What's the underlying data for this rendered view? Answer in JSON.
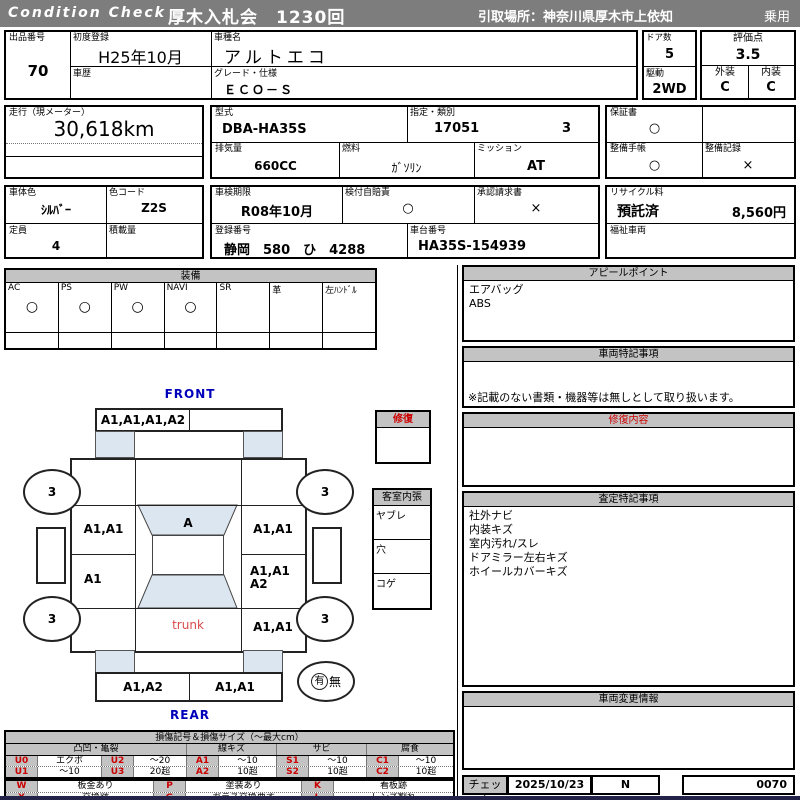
{
  "header": {
    "brand": "Condition Check",
    "auction": "厚木入札会　1230回",
    "pickup": "引取場所：神奈川県厚木市上依知",
    "usage": "乗用"
  },
  "info": {
    "lot_label": "出品番号",
    "lot": "70",
    "first_reg_label": "初度登録",
    "first_reg": "H25年10月",
    "history_label": "車歴",
    "model_name_label": "車種名",
    "model_name": "アルトエコ",
    "grade_label": "グレード・仕様",
    "grade": "ＥＣＯ－Ｓ",
    "doors_label": "ドア数",
    "doors": "5",
    "drive_label": "駆動",
    "drive": "2WD",
    "score_label": "評価点",
    "score": "3.5",
    "exterior_label": "外装",
    "exterior": "C",
    "interior_label": "内装",
    "interior": "C",
    "mileage_label": "走行（現メーター）",
    "mileage": "30,618km",
    "model_code_label": "型式",
    "model_code": "DBA-HA35S",
    "class_label": "指定・類別",
    "class_no": "17051",
    "class_sub": "3",
    "warranty_label": "保証書",
    "warranty": "○",
    "displacement_label": "排気量",
    "displacement": "660CC",
    "fuel_label": "燃料",
    "fuel": "ｶﾞｿﾘﾝ",
    "transmission_label": "ミッション",
    "transmission": "AT",
    "maint_book_label": "整備手帳",
    "maint_book": "○",
    "maint_record_label": "整備記録",
    "maint_record": "×",
    "body_color_label": "車体色",
    "body_color": "ｼﾙﾊﾞｰ",
    "color_code_label": "色コード",
    "color_code": "Z2S",
    "inspection_label": "車検期限",
    "inspection": "R08年10月",
    "insurance_label": "検付自賠責",
    "insurance": "○",
    "approval_label": "承認請求書",
    "approval": "×",
    "recycle_label": "リサイクル料",
    "recycle_status": "預託済",
    "recycle_fee": "8,560円",
    "capacity_label": "定員",
    "capacity": "4",
    "load_label": "積載量",
    "reg_no_label": "登録番号",
    "reg_no": "静岡　580　ひ　4288",
    "chassis_label": "車台番号",
    "chassis": "HA35S-154939",
    "welfare_label": "福祉車両"
  },
  "equipment": {
    "title": "装備",
    "items": [
      {
        "label": "AC",
        "value": "○"
      },
      {
        "label": "PS",
        "value": "○"
      },
      {
        "label": "PW",
        "value": "○"
      },
      {
        "label": "NAVI",
        "value": "○"
      },
      {
        "label": "SR",
        "value": ""
      },
      {
        "label": "革",
        "value": ""
      },
      {
        "label": "左ﾊﾝﾄﾞﾙ",
        "value": ""
      }
    ]
  },
  "panels": {
    "appeal": {
      "title": "アピールポイント",
      "lines": [
        "エアバッグ",
        "ABS"
      ]
    },
    "vehicle_notes": {
      "title": "車両特記事項",
      "note": "※記載のない書類・機器等は無しとして取り扱います。"
    },
    "repair": {
      "title": "修復内容"
    },
    "assessment": {
      "title": "査定特記事項",
      "lines": [
        "社外ナビ",
        "内装キズ",
        "室内汚れ/スレ",
        "ドアミラー左右キズ",
        "ホイールカバーキズ"
      ]
    },
    "changes": {
      "title": "車両変更情報"
    },
    "check": {
      "label": "チェック",
      "date": "2025/10/23",
      "code": "N",
      "number": "0070"
    }
  },
  "diagram": {
    "front_label": "FRONT",
    "rear_label": "REAR",
    "trunk_label": "trunk",
    "front_bumper_left": "A1,A1,A1,A2",
    "windshield": "A",
    "left_front_door": "A1,A1",
    "left_rear_door": "A1",
    "right_front_door": "A1,A1",
    "right_rear_door_line1": "A1,A1",
    "right_rear_door_line2": "A2",
    "right_rear_fender": "A1,A1",
    "rear_bumper_left": "A1,A2",
    "rear_bumper_right": "A1,A1",
    "tire_fl": "3",
    "tire_fr": "3",
    "tire_rl": "3",
    "tire_rr": "3",
    "spare_present": "有",
    "spare_absent": "無",
    "repair_box": "修復",
    "interior_panel_title": "客室内張",
    "interior_items": [
      "ヤブレ",
      "穴",
      "コゲ"
    ]
  },
  "legend": {
    "title": "損傷記号＆損傷サイズ（～最大cm）",
    "groups": [
      "凸凹・亀裂",
      "線キズ",
      "サビ",
      "腐食"
    ],
    "rows": [
      [
        "U0",
        "エクボ",
        "U2",
        "～20",
        "A1",
        "～10",
        "S1",
        "～10",
        "C1",
        "～10"
      ],
      [
        "U1",
        "～10",
        "U3",
        "20超",
        "A2",
        "10超",
        "S2",
        "10超",
        "C2",
        "10超"
      ]
    ],
    "rows2": [
      [
        "W",
        "板金あり",
        "P",
        "塗装あり",
        "K",
        "看板跡"
      ],
      [
        "X",
        "交換跡",
        "G",
        "ガラス交換要す",
        "L",
        "レンズ割れ"
      ]
    ]
  }
}
